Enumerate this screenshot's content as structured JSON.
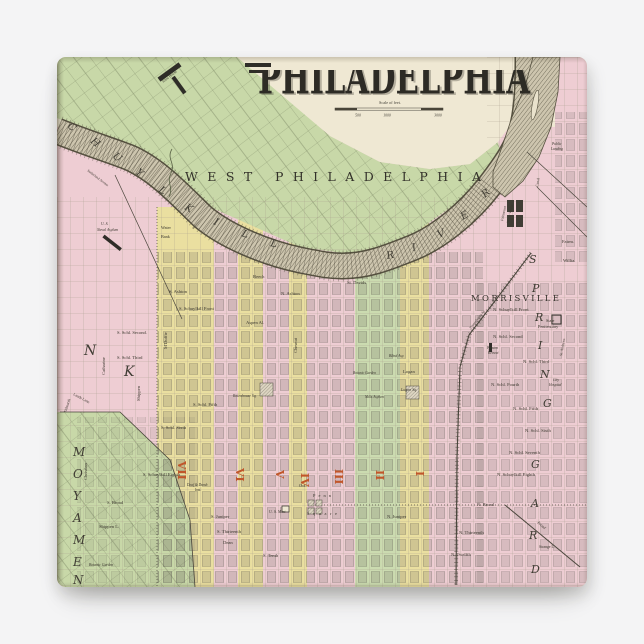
{
  "page": {
    "background": "#f4f4f5"
  },
  "map": {
    "title": "PHILADELPHIA",
    "palette": {
      "paper_cream": "#efe8d3",
      "green": "#c8d8a8",
      "pink": "#eecdd3",
      "yellow": "#eadfa0",
      "stripe_green": "#cbdbb0",
      "river_fill": "#cdc5ae",
      "river_line": "#6e6957",
      "ink": "#38352c",
      "ward_orange": "#c0562a"
    },
    "scale_bar": {
      "label": "Scale of feet.",
      "ticks": [
        "500",
        "1000",
        "3000"
      ]
    },
    "spreads": [
      {
        "t": "WEST PHILADELPHIA",
        "x": 128,
        "y": 124,
        "s": 12.5,
        "tl": 296
      },
      {
        "t": "MORRISVILLE",
        "x": 414,
        "y": 244,
        "s": 8.5,
        "tl": 88
      }
    ],
    "letters": [
      {
        "t": "C",
        "x": 10,
        "y": 70,
        "r": 40
      },
      {
        "t": "H",
        "x": 33,
        "y": 85,
        "r": 40
      },
      {
        "t": "U",
        "x": 55,
        "y": 100,
        "r": 40
      },
      {
        "t": "Y",
        "x": 78,
        "y": 116,
        "r": 40
      },
      {
        "t": "L",
        "x": 101,
        "y": 134,
        "r": 36
      },
      {
        "t": "K",
        "x": 127,
        "y": 152,
        "r": 30
      },
      {
        "t": "I",
        "x": 156,
        "y": 167,
        "r": 24
      },
      {
        "t": "L",
        "x": 184,
        "y": 179,
        "r": 18
      },
      {
        "t": "L",
        "x": 213,
        "y": 189,
        "r": 12
      },
      {
        "t": "R",
        "x": 330,
        "y": 202,
        "r": -10
      },
      {
        "t": "I",
        "x": 356,
        "y": 194,
        "r": -16
      },
      {
        "t": "V",
        "x": 382,
        "y": 181,
        "r": -24
      },
      {
        "t": "E",
        "x": 406,
        "y": 163,
        "r": -33
      },
      {
        "t": "R",
        "x": 428,
        "y": 141,
        "r": -42
      },
      {
        "t": "M",
        "x": 16,
        "y": 399,
        "s": 12
      },
      {
        "t": "O",
        "x": 16,
        "y": 421,
        "s": 12
      },
      {
        "t": "Y",
        "x": 16,
        "y": 443,
        "s": 12
      },
      {
        "t": "A",
        "x": 16,
        "y": 465,
        "s": 12
      },
      {
        "t": "M",
        "x": 16,
        "y": 487,
        "s": 12
      },
      {
        "t": "E",
        "x": 16,
        "y": 509,
        "s": 12
      },
      {
        "t": "N",
        "x": 16,
        "y": 527,
        "s": 12
      },
      {
        "t": "N",
        "x": 27,
        "y": 298,
        "s": 14
      },
      {
        "t": "K",
        "x": 67,
        "y": 319,
        "s": 14
      },
      {
        "t": "S",
        "x": 472,
        "y": 206,
        "s": 11
      },
      {
        "t": "P",
        "x": 475,
        "y": 235,
        "s": 11
      },
      {
        "t": "R",
        "x": 478,
        "y": 264,
        "s": 11
      },
      {
        "t": "I",
        "x": 481,
        "y": 292,
        "s": 11
      },
      {
        "t": "N",
        "x": 483,
        "y": 321,
        "s": 11
      },
      {
        "t": "G",
        "x": 486,
        "y": 350,
        "s": 11
      },
      {
        "t": "G",
        "x": 474,
        "y": 411,
        "s": 11
      },
      {
        "t": "A",
        "x": 474,
        "y": 450,
        "s": 11
      },
      {
        "t": "R",
        "x": 472,
        "y": 482,
        "s": 11
      },
      {
        "t": "D",
        "x": 474,
        "y": 516,
        "s": 11
      }
    ],
    "wards": [
      {
        "t": "VII",
        "x": 121,
        "y": 404
      },
      {
        "t": "VI",
        "x": 179,
        "y": 411
      },
      {
        "t": "V",
        "x": 219,
        "y": 413
      },
      {
        "t": "IV",
        "x": 244,
        "y": 416
      },
      {
        "t": "III",
        "x": 278,
        "y": 412
      },
      {
        "t": "II",
        "x": 319,
        "y": 413
      },
      {
        "t": "I",
        "x": 359,
        "y": 414
      }
    ],
    "street_labels": [
      {
        "t": "Alms House",
        "x": 106,
        "y": 26,
        "r": -38,
        "s": 3.6
      },
      {
        "t": "Sutherland Avenue",
        "x": 30,
        "y": 114,
        "r": 37,
        "s": 3.4
      },
      {
        "t": "U. S.",
        "x": 44,
        "y": 168,
        "s": 3.8,
        "k": "it"
      },
      {
        "t": "Naval Asylum",
        "x": 40,
        "y": 174,
        "s": 3.8,
        "k": "it"
      },
      {
        "t": "Water",
        "x": 104,
        "y": 172,
        "s": 4.2
      },
      {
        "t": "Bank",
        "x": 104,
        "y": 181,
        "s": 4.2
      },
      {
        "t": "S. Ashton",
        "x": 112,
        "y": 236
      },
      {
        "t": "S. Schuylkill Front",
        "x": 122,
        "y": 253
      },
      {
        "t": "S. Schl. Second.",
        "x": 60,
        "y": 277
      },
      {
        "t": "S. Schl. Third",
        "x": 60,
        "y": 302
      },
      {
        "t": "S. Schl. Fifth",
        "x": 136,
        "y": 349
      },
      {
        "t": "S. Schl. Sixth",
        "x": 104,
        "y": 372
      },
      {
        "t": "S. Schuylkill Eighth",
        "x": 86,
        "y": 419
      },
      {
        "t": "S. Broad",
        "x": 50,
        "y": 447
      },
      {
        "t": "Shippen L.",
        "x": 42,
        "y": 471
      },
      {
        "t": "Christian",
        "x": 30,
        "y": 423,
        "r": -90
      },
      {
        "t": "Catharine",
        "x": 48,
        "y": 318,
        "r": -90
      },
      {
        "t": "Shippen",
        "x": 83,
        "y": 344,
        "r": -90
      },
      {
        "t": "M'Duffie",
        "x": 110,
        "y": 292,
        "r": -90
      },
      {
        "t": "Lands Lane",
        "x": 16,
        "y": 338,
        "r": 28,
        "s": 3.8
      },
      {
        "t": "Tidmarsh",
        "x": 9,
        "y": 356,
        "r": -72,
        "s": 3.8
      },
      {
        "t": "Botanic Garden",
        "x": 32,
        "y": 509,
        "s": 3.8,
        "k": "it"
      },
      {
        "t": "Beech",
        "x": 196,
        "y": 221
      },
      {
        "t": "Aspen Al.",
        "x": 189,
        "y": 267
      },
      {
        "t": "Chesnut",
        "x": 240,
        "y": 296,
        "r": -90
      },
      {
        "t": "Rittenhouse Sq.",
        "x": 176,
        "y": 340,
        "s": 3.8,
        "k": "it"
      },
      {
        "t": "St. Davids",
        "x": 290,
        "y": 227
      },
      {
        "t": "N. Ashton",
        "x": 224,
        "y": 238
      },
      {
        "t": "Blind Asy.",
        "x": 332,
        "y": 300,
        "s": 3.8,
        "k": "it"
      },
      {
        "t": "Botanic Garden",
        "x": 296,
        "y": 317,
        "s": 3.6,
        "k": "it"
      },
      {
        "t": "Mills Asylum",
        "x": 308,
        "y": 341,
        "s": 3.6,
        "k": "it"
      },
      {
        "t": "Logan",
        "x": 346,
        "y": 316
      },
      {
        "t": "Logan Sq.",
        "x": 344,
        "y": 334,
        "s": 4,
        "k": "it"
      },
      {
        "t": "Oak",
        "x": 242,
        "y": 430,
        "s": 4
      },
      {
        "t": "Penn",
        "x": 256,
        "y": 440,
        "s": 4.4,
        "tl": 18
      },
      {
        "t": "Square",
        "x": 250,
        "y": 458,
        "s": 4.4,
        "tl": 30
      },
      {
        "t": "U. S. Mint",
        "x": 212,
        "y": 456,
        "s": 4,
        "k": "it"
      },
      {
        "t": "S. Juniper",
        "x": 154,
        "y": 461
      },
      {
        "t": "S. Thirteenth",
        "x": 160,
        "y": 476
      },
      {
        "t": "Dean",
        "x": 166,
        "y": 487
      },
      {
        "t": "S. Tenth",
        "x": 206,
        "y": 500
      },
      {
        "t": "Deaf & Dumb",
        "x": 130,
        "y": 429,
        "s": 3.6,
        "k": "it"
      },
      {
        "t": "Inst.",
        "x": 138,
        "y": 434,
        "s": 3.6,
        "k": "it"
      },
      {
        "t": "Fairmount",
        "x": 446,
        "y": 164,
        "r": -78,
        "s": 3.6
      },
      {
        "t": "Water Works",
        "x": 452,
        "y": 166,
        "r": -78,
        "s": 3.6
      },
      {
        "t": "Canal",
        "x": 481,
        "y": 130,
        "r": -80,
        "s": 3.8
      },
      {
        "t": "Public",
        "x": 495,
        "y": 88,
        "s": 3.6,
        "k": "it"
      },
      {
        "t": "Landing",
        "x": 494,
        "y": 93,
        "s": 3.6,
        "k": "it"
      },
      {
        "t": "Fairm.",
        "x": 505,
        "y": 186
      },
      {
        "t": "Willia.",
        "x": 506,
        "y": 205
      },
      {
        "t": "Pennsylvania Av.",
        "x": 414,
        "y": 272,
        "r": -52,
        "s": 3.4
      },
      {
        "t": "N. Schuylkill Front",
        "x": 436,
        "y": 254
      },
      {
        "t": "State",
        "x": 489,
        "y": 265,
        "s": 4.2
      },
      {
        "t": "Penitentiary",
        "x": 481,
        "y": 271,
        "s": 4.2
      },
      {
        "t": "N. Schl. Second",
        "x": 436,
        "y": 281
      },
      {
        "t": "Preston",
        "x": 430,
        "y": 292,
        "s": 3.6,
        "k": "it"
      },
      {
        "t": "Retreat",
        "x": 431,
        "y": 297,
        "s": 3.6,
        "k": "it"
      },
      {
        "t": "N. Schl. Third",
        "x": 466,
        "y": 306
      },
      {
        "t": "St. Andrews",
        "x": 505,
        "y": 299,
        "r": -80,
        "s": 3.6
      },
      {
        "t": "N. Schl. Fourth",
        "x": 434,
        "y": 329
      },
      {
        "t": "City",
        "x": 496,
        "y": 324,
        "s": 3.6,
        "k": "it"
      },
      {
        "t": "Hospital",
        "x": 492,
        "y": 329,
        "s": 3.6,
        "k": "it"
      },
      {
        "t": "N. Schl. Fifth",
        "x": 456,
        "y": 353
      },
      {
        "t": "N. Schl. Sixth",
        "x": 468,
        "y": 375
      },
      {
        "t": "N. Schl. Seventh",
        "x": 452,
        "y": 397
      },
      {
        "t": "N. Schuylkill Eighth",
        "x": 440,
        "y": 419
      },
      {
        "t": "N. Broad",
        "x": 420,
        "y": 449
      },
      {
        "t": "N. Juniper",
        "x": 330,
        "y": 461
      },
      {
        "t": "N. Thirteenth",
        "x": 402,
        "y": 477
      },
      {
        "t": "N. Twelfth",
        "x": 394,
        "y": 499
      },
      {
        "t": "Broad",
        "x": 480,
        "y": 466,
        "r": 40,
        "s": 4,
        "k": "it"
      },
      {
        "t": "Strange L.",
        "x": 482,
        "y": 491,
        "s": 3.8
      }
    ]
  }
}
